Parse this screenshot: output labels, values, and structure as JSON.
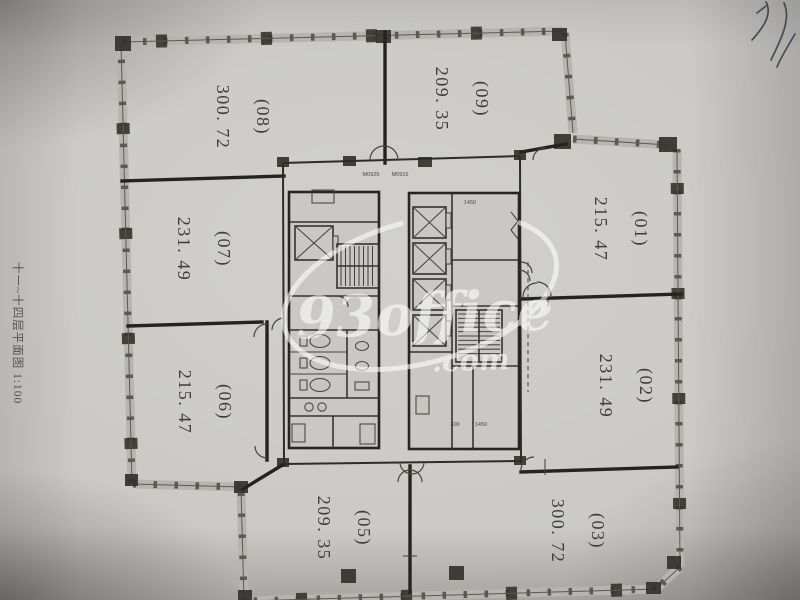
{
  "caption": {
    "text": "十一~十四层平面图 1:100"
  },
  "watermark": {
    "brand": "93office",
    "suffix": ".com",
    "color": "#ffffff"
  },
  "rooms": [
    {
      "id": "(08)",
      "area": "300. 72"
    },
    {
      "id": "(09)",
      "area": "209. 35"
    },
    {
      "id": "(01)",
      "area": "215. 47"
    },
    {
      "id": "(02)",
      "area": "231. 49"
    },
    {
      "id": "(03)",
      "area": "300. 72"
    },
    {
      "id": "(05)",
      "area": "209. 35"
    },
    {
      "id": "(06)",
      "area": "215. 47"
    },
    {
      "id": "(07)",
      "area": "231. 49"
    }
  ],
  "core": {
    "door_tags": [
      "M0925",
      "M0915"
    ],
    "dim_top": "1450",
    "dim_bottom_a": "300",
    "dim_bottom_b": "1450"
  },
  "colors": {
    "paper": "#c8c7c3",
    "ink": "#333333",
    "wall": "#24231f",
    "label": "#3e3d3b",
    "watermark": "#ffffff"
  }
}
